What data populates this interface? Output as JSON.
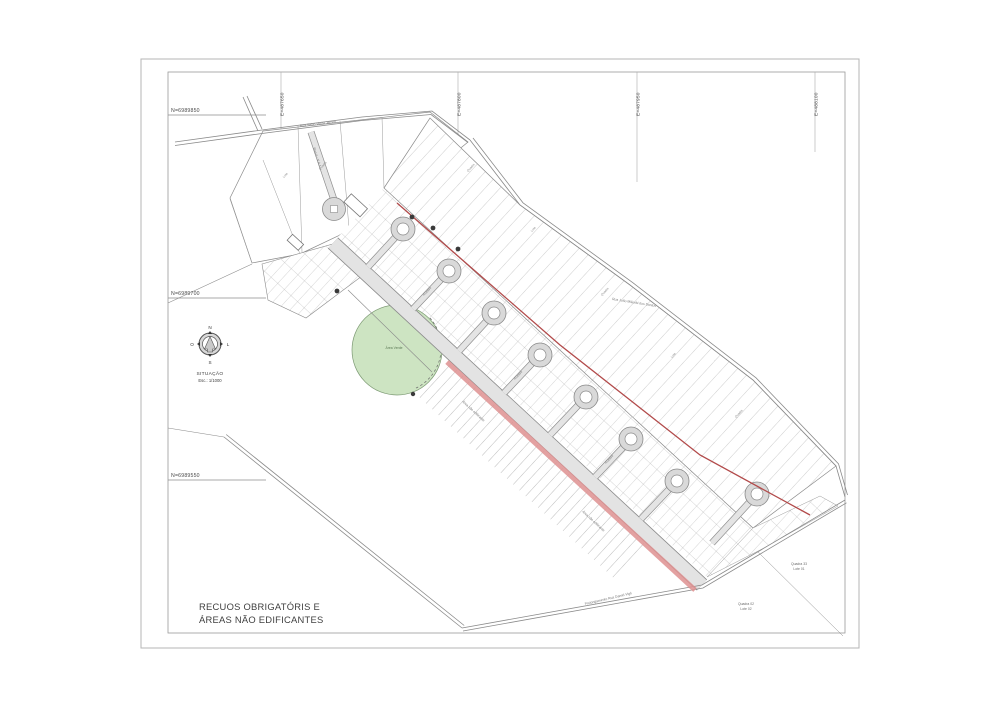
{
  "sheet": {
    "title_line1": "RECUOS OBRIGATÓRIS E",
    "title_line2": "ÁREAS NÃO EDIFICANTES"
  },
  "grid": {
    "north_labels": [
      "N=6989850",
      "N=6989700",
      "N=6989550"
    ],
    "east_labels": [
      "E=487650",
      "E=487800",
      "E=487950",
      "E=488100"
    ]
  },
  "compass": {
    "points": {
      "n": "N",
      "l": "L",
      "s": "S",
      "o": "O"
    },
    "caption": "SITUAÇÃO",
    "scale": "Esc.: 1/1000"
  },
  "map": {
    "street_names": {
      "top_road": "Rua Selso Vieira Jardim",
      "ne_road": "Rua João Milioski dos Santos",
      "bottom_road": "Prolongamento Rua Daniel Vigil",
      "rua_a": "Rua A - V.A.1",
      "access": "Acesso"
    },
    "avenue_note": "Área não edificante",
    "park_label": "Área Verde",
    "generic": {
      "quadra": "Quadra",
      "lote": "Lote"
    },
    "lot_labels": [
      {
        "quadra": "Quadra 33",
        "lote": "Lote 01"
      },
      {
        "quadra": "Quadra 02",
        "lote": "Lote 02"
      }
    ],
    "colors": {
      "restriction_red": "#b24a4a",
      "setback_band": "#de9191",
      "park_green": "#cde4c2",
      "road_gray": "#8a8a8a"
    }
  }
}
